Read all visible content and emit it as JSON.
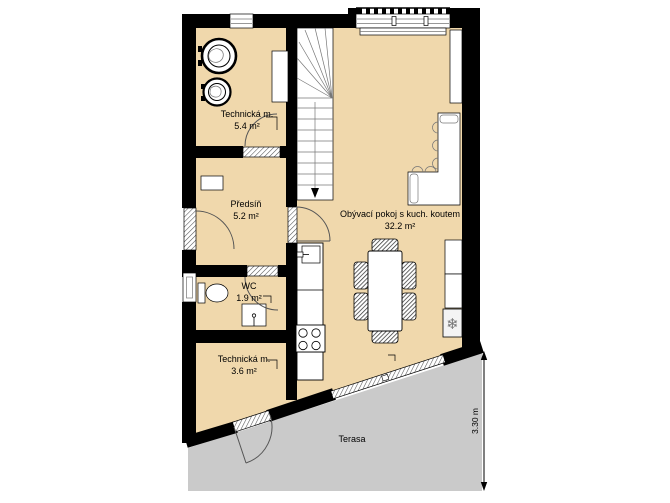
{
  "plan": {
    "rooms": [
      {
        "name": "Technická m.",
        "area": "5.4 m²"
      },
      {
        "name": "Předsíň",
        "area": "5.2 m²"
      },
      {
        "name": "WC",
        "area": "1.9 m²"
      },
      {
        "name": "Technická m.",
        "area": "3.6 m²"
      },
      {
        "name": "Obývací pokoj s kuch. koutem",
        "area": "32.2 m²"
      },
      {
        "name": "Terasa"
      }
    ],
    "dimension": {
      "label": "3.30 m"
    },
    "symbols": {
      "snowflake": "❄"
    },
    "colors": {
      "floor": "#F0D8AC",
      "terrace": "#CACACA",
      "wall": "#000000",
      "fixture": "#FFFFFF"
    }
  }
}
